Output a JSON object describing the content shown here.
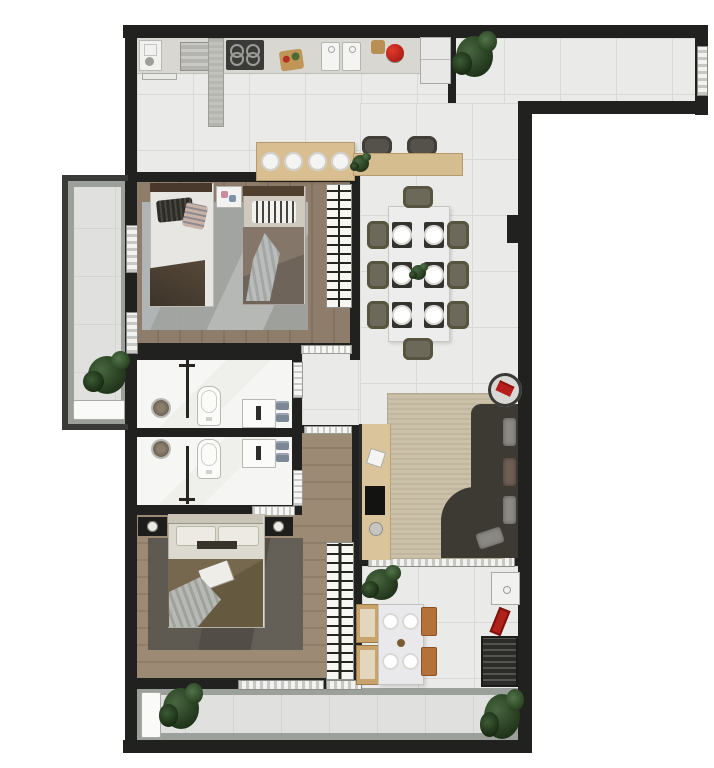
{
  "scene": {
    "type": "apartment-floor-plan-render",
    "view": "top-down",
    "canvas": {
      "width": 714,
      "height": 768
    }
  },
  "palette": {
    "wall": "#212220",
    "tile": "#eaeae8",
    "balcony_tile": "#e0e1df",
    "wood_bedroom": "#8a7968",
    "wood_master": "#9a8672",
    "marble": "#f3f3f1",
    "counter": "#d8d7d2",
    "island_wood": "#d9be92",
    "sofa": "#3d3933",
    "rug_living": "#c9bfa6",
    "rug_bedroom1": "#aeb3b4",
    "rug_master": "#57544c",
    "dining_chair": "#6c685a",
    "accent_red": "#c01f1f",
    "towel": "#7c8896",
    "plant_green": "#2c4527",
    "grill": "#2b2b29",
    "wood_chair": "#b5713a"
  },
  "rooms": [
    {
      "name": "kitchen",
      "furniture": [
        "sink-unit",
        "towel-bar",
        "range-hood",
        "peninsula-counter",
        "cooktop-4-burners",
        "cutting-board",
        "two-trays",
        "basket",
        "red-kettle",
        "fridge",
        "island-with-4-stools",
        "buffet-counter-with-plant",
        "two-counter-chairs"
      ]
    },
    {
      "name": "entry-hall",
      "furniture": [
        "corner-plant",
        "entry-door"
      ]
    },
    {
      "name": "dining-room",
      "furniture": [
        "table-for-8",
        "8-chairs",
        "6-place-settings",
        "centerpiece-plant"
      ]
    },
    {
      "name": "bedroom-1",
      "furniture": [
        "single-bed-left",
        "single-bed-right",
        "shared-nightstand",
        "area-rug",
        "wardrobe-rack"
      ]
    },
    {
      "name": "bathroom-1",
      "furniture": [
        "shower",
        "glass-partition",
        "toilet",
        "vanity-sink",
        "two-towels"
      ]
    },
    {
      "name": "bathroom-2",
      "furniture": [
        "shower",
        "glass-partition",
        "toilet",
        "vanity-sink",
        "two-towels"
      ]
    },
    {
      "name": "living-room",
      "furniture": [
        "l-shaped-sofa",
        "throw-pillows",
        "area-rug",
        "tv-console",
        "tv",
        "round-side-table-with-red-book"
      ]
    },
    {
      "name": "master-suite",
      "furniture": [
        "double-bed",
        "two-nightstands-with-lamps",
        "area-rug",
        "wardrobe-rack",
        "entry-corridor"
      ]
    },
    {
      "name": "gourmet-balcony",
      "furniture": [
        "square-table-4-plates",
        "four-chairs",
        "potted-plant",
        "counter-sink",
        "red-grill-tools",
        "barbecue-grill"
      ]
    },
    {
      "name": "side-balcony",
      "furniture": [
        "plant",
        "white-bench"
      ]
    },
    {
      "name": "bottom-balcony",
      "furniture": [
        "white-bench",
        "plant-left",
        "plant-right"
      ]
    }
  ]
}
